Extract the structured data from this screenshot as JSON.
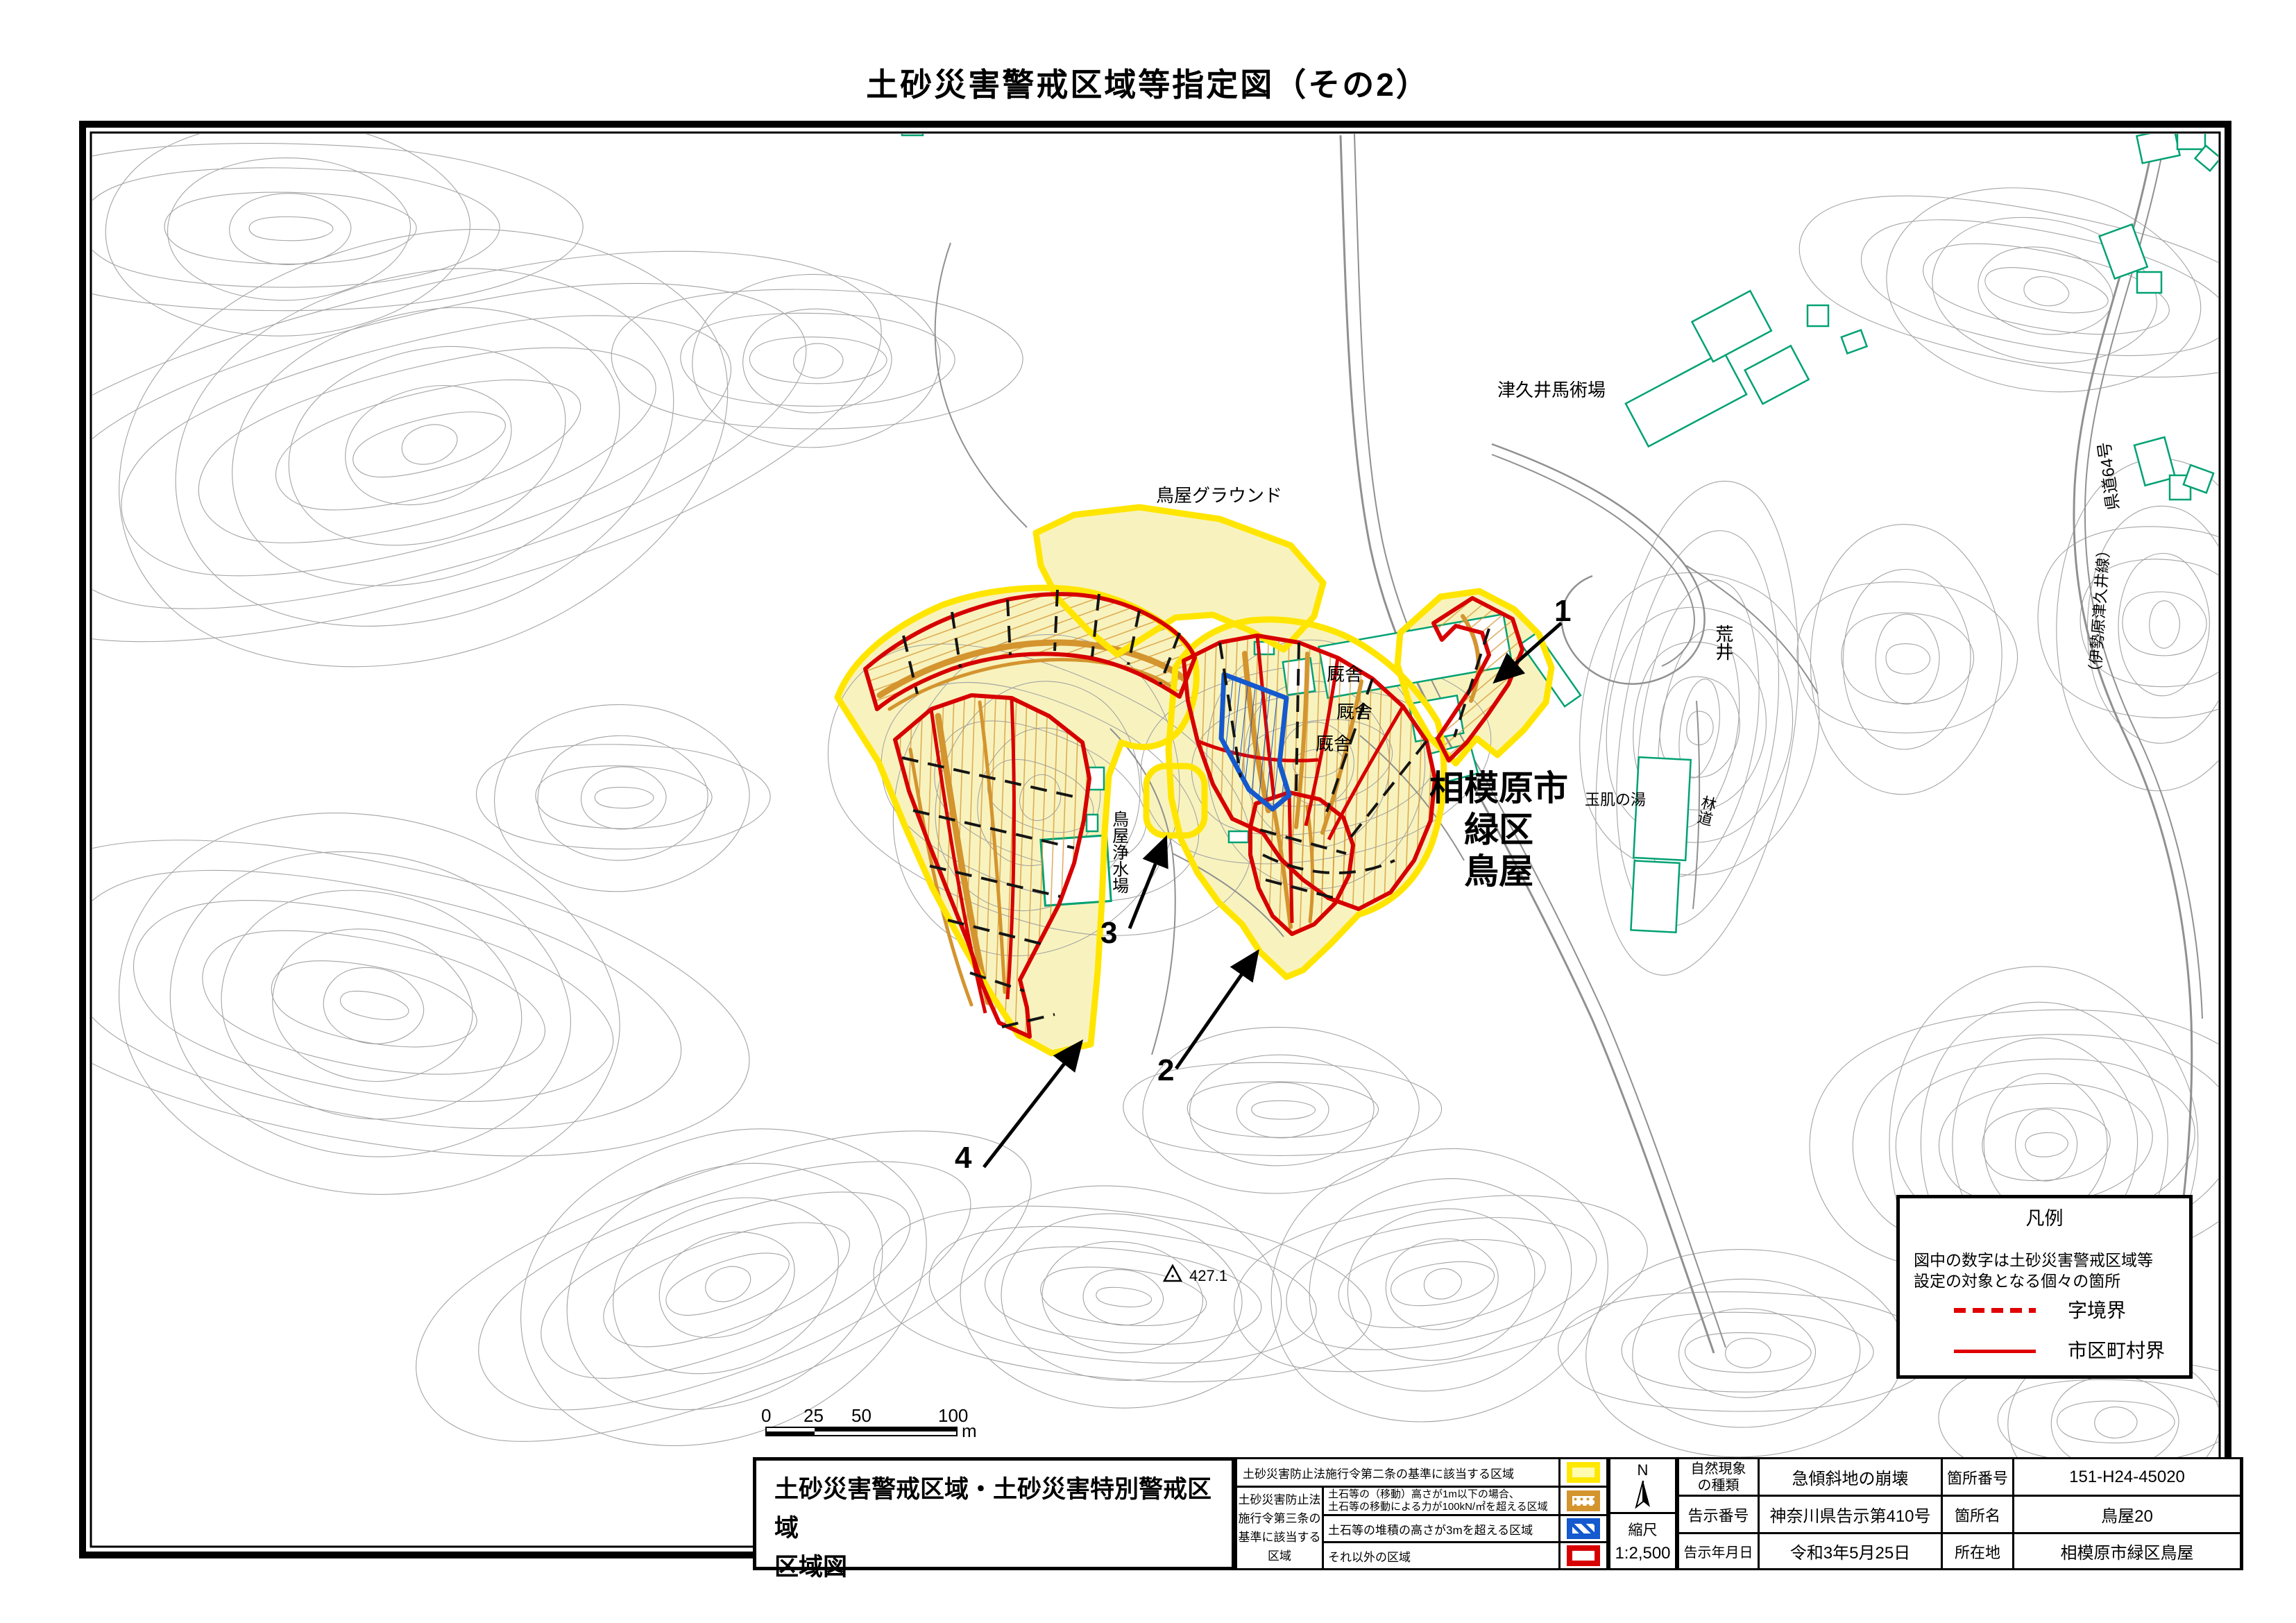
{
  "title": "土砂災害警戒区域等指定図（その2）",
  "map_labels": {
    "ground": "鳥屋グラウンド",
    "stable1": "厩舎",
    "stable2": "厩舎",
    "stable3": "厩舎",
    "equestrian": "津久井馬術場",
    "city_line1": "相模原市",
    "city_line2": "緑区",
    "city_line3": "鳥屋",
    "spa": "玉肌の湯",
    "forest_road": "林道",
    "arai": "荒井",
    "route_main": "県道64号",
    "route_sub": "（伊勢原津久井線）",
    "water_plant": "鳥屋浄水場",
    "elevation": "427.1",
    "num1": "1",
    "num2": "2",
    "num3": "3",
    "num4": "4"
  },
  "legend_box": {
    "title": "凡例",
    "note": "図中の数字は土砂災害警戒区域等\n設定の対象となる個々の箇所",
    "dashed_label": "字境界",
    "solid_label": "市区町村界"
  },
  "scale_bar": {
    "t0": "0",
    "t25": "25",
    "t50": "50",
    "t100": "100",
    "unit": "m"
  },
  "sheet": {
    "block_title": "土砂災害警戒区域・土砂災害特別警戒区域\n区域図",
    "legend_rows": {
      "row1": "土砂災害防止法施行令第二条の基準に該当する区域",
      "law_label": "土砂災害防止法\n施行令第三条の\n基準に該当する\n区域",
      "row2": "土石等の（移動）高さが1m以下の場合、\n土石等の移動による力が100kN/㎡を超える区域",
      "row3": "土石等の堆積の高さが3mを超える区域",
      "row4": "それ以外の区域"
    },
    "compass_n": "N",
    "scale_label": "縮尺",
    "scale_value": "1:2,500",
    "info_table": {
      "rows": [
        {
          "c": [
            "自然現象\nの種類",
            "急傾斜地の崩壊",
            "箇所番号",
            "151-H24-45020"
          ]
        },
        {
          "c": [
            "告示番号",
            "神奈川県告示第410号",
            "箇所名",
            "鳥屋20"
          ]
        },
        {
          "c": [
            "告示年月日",
            "令和3年5月25日",
            "所在地",
            "相模原市緑区鳥屋"
          ]
        }
      ]
    }
  },
  "colors": {
    "zone_yellow_fill": "#F8F3BE",
    "zone_yellow_border": "#FFE500",
    "zone_special_red": "#D70000",
    "zone_orange_hatch": "#D4942E",
    "zone_blue": "#1559CE",
    "building_green": "#00A173",
    "contour_gray": "#A4A4A4",
    "boundary_red": "#E00000"
  }
}
